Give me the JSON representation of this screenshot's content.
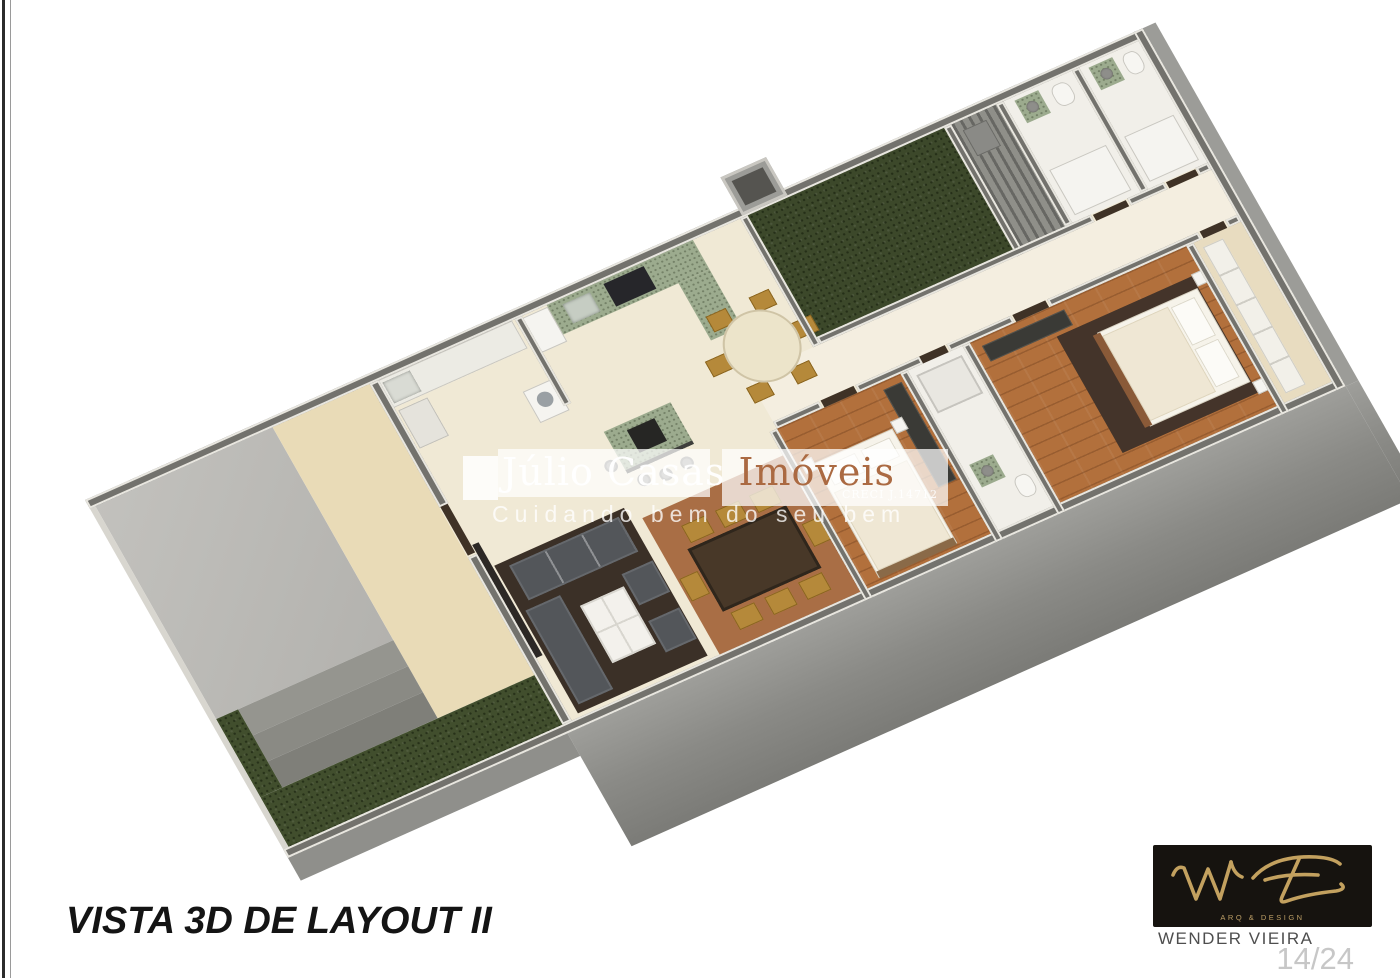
{
  "page": {
    "view_title": "VISTA 3D DE LAYOUT II"
  },
  "watermark": {
    "brand_primary": "Júlio Casas ",
    "brand_accent": "Imóveis",
    "license": "CRECI J.14712",
    "tagline": "Cuidando bem do seu bem",
    "accent_color": "#ab6a42",
    "band_color": "rgba(255,255,255,0.72)"
  },
  "signature_block": {
    "studio_caption": "ARQ & DESIGN",
    "architect_name": "WENDER VIEIRA",
    "page_indicator": "14/24",
    "gold_color": "#c3a15f",
    "box_color": "#16130f"
  },
  "floorplan": {
    "view": "3D isometric floor plan, layout option II",
    "colors": {
      "wall_gray": "#73726d",
      "wall_top_white": "#e8e6df",
      "interior_floor_cream": "#f0e9d5",
      "patio_slab_beige": "#e9dbb7",
      "driveway_concrete": "#bab9b4",
      "grass_green": "#414e2d",
      "wood_floor": "#b2703c",
      "kitchen_counter_green": "#9cab8e",
      "living_rug_dark": "#3b3027",
      "dining_rug_sienna": "#a96e45",
      "sofa_charcoal": "#53565a",
      "chair_gold": "#b5893a",
      "facade_gray": "#8a8a86"
    }
  }
}
